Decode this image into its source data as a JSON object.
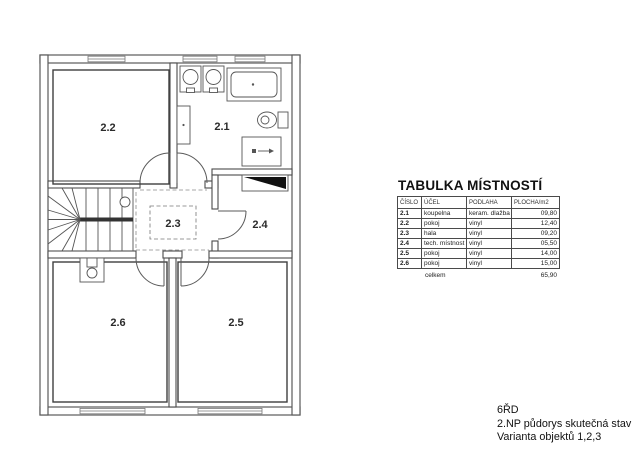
{
  "floor_plan": {
    "rooms": [
      {
        "label": "2.1"
      },
      {
        "label": "2.2"
      },
      {
        "label": "2.3"
      },
      {
        "label": "2.4"
      },
      {
        "label": "2.5"
      },
      {
        "label": "2.6"
      }
    ],
    "colors": {
      "wall_line": "#4a4a4a",
      "room_line": "#3f3f3f",
      "dash_line": "#8a8a8a"
    }
  },
  "table": {
    "title": "TABULKA MÍSTNOSTÍ",
    "columns": [
      "ČÍSLO",
      "ÚČEL",
      "PODLAHA",
      "PLOCHA/m2"
    ],
    "rows": [
      [
        "2.1",
        "koupelna",
        "keram. dlažba",
        "09,80"
      ],
      [
        "2.2",
        "pokoj",
        "vinyl",
        "12,40"
      ],
      [
        "2.3",
        "hala",
        "vinyl",
        "09,20"
      ],
      [
        "2.4",
        "tech. místnost",
        "vinyl",
        "05,50"
      ],
      [
        "2.5",
        "pokoj",
        "vinyl",
        "14,00"
      ],
      [
        "2.6",
        "pokoj",
        "vinyl",
        "15,00"
      ]
    ],
    "total_label": "celkem",
    "total_value": "65,90"
  },
  "title_block": {
    "line1": "6ŘD",
    "line2": "2.NP půdorys skutečná stav",
    "line3": "Varianta objektů 1,2,3"
  }
}
